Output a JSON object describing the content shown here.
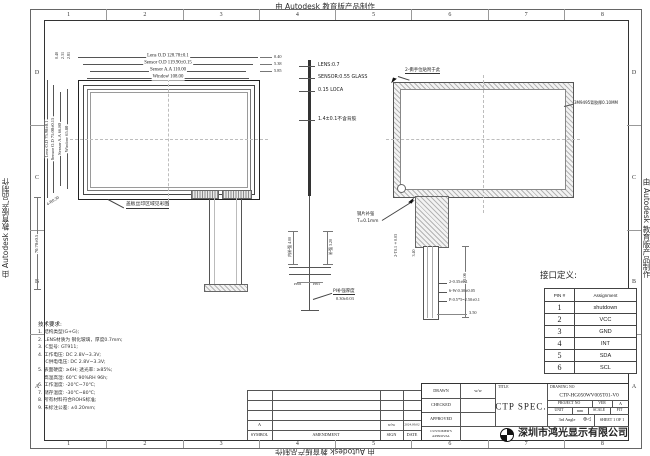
{
  "watermark": "由 Autodesk 教育版产品制作",
  "zones": {
    "cols": [
      "1",
      "2",
      "3",
      "4",
      "5",
      "6",
      "7",
      "8"
    ],
    "rows": [
      "D",
      "C",
      "B",
      "A"
    ]
  },
  "front": {
    "h_dims": [
      "Lens O.D 128.78±0.1",
      "Sensor O.D 119.90±0.15",
      "Sensor A.A 110.00",
      "Window 108.00"
    ],
    "v_dims": [
      "Lens O.D 75.98±0.1",
      "Sensor O.D 75.00±0.15",
      "Sensor A.A 66.80",
      "Window 65.80"
    ],
    "top_offsets": [
      "0.40",
      "2.31",
      "2.81"
    ],
    "right_offsets": [
      "0.40",
      "5.38",
      "5.85"
    ],
    "corner_note": "4-R0.30",
    "silk_note": "盖板丝印区域见彩图",
    "tail_dim": "70.70±0.5"
  },
  "stack": {
    "layers": [
      "LENS:0.7",
      "SENSOR:0.55 GLASS",
      "0.15 LOCA",
      "1.4±0.1不含背胶"
    ],
    "dim_left": "内补强 4.00",
    "dim_right": "补强 3.20",
    "pin_left": "PIN6",
    "pin_right": "PIN1",
    "callout_line1": "PI补强厚度",
    "callout_line2": "0.30±0.03"
  },
  "back": {
    "tear_note": "2-撕手位贴附于此",
    "tape_note": "3M9495背胶厚0.10MM",
    "stiffener_note1": "钢片补强",
    "stiffener_note2": "T=0.1mm",
    "side_note": "2-T0.1±0.03",
    "dim_a": "3.40",
    "dim_b": "22.06",
    "dim_c": "3.50",
    "specs": [
      "2-0.35±0.1",
      "6-W:0.30±0.05",
      "P:0.5*5=2.50±0.1"
    ]
  },
  "pin_table": {
    "title": "接口定义:",
    "headers": [
      "PIN #",
      "Assignment"
    ],
    "rows": [
      [
        "1",
        "shutdown"
      ],
      [
        "2",
        "VCC"
      ],
      [
        "3",
        "GND"
      ],
      [
        "4",
        "INT"
      ],
      [
        "5",
        "SDA"
      ],
      [
        "6",
        "SCL"
      ]
    ]
  },
  "notes": {
    "title": "技术要求:",
    "items": [
      "1. 结构类型(G+G);",
      "2. LENS材质为 钢化玻璃，厚度0.7mm;",
      "3. IC型号: GT911;",
      "4. 工作电压: DC 2.8V~3.3V;",
      "    IC供电电压: DC 2.8V~3.3V;",
      "5. 表面硬度: ≥6H; 透光率: ≥85%;",
      "    高温高湿: 60℃ 90%RH 96h;",
      "6. 工作温度: -20℃~70℃;",
      "7. 储存温度: -30℃~80℃;",
      "8. 所有材料符合ROHS标准;",
      "9. 未标注公差: ±0.20mm;"
    ]
  },
  "revision": {
    "headers": [
      "SYMBOL",
      "AMENDMENT",
      "SIGN",
      "DATE"
    ],
    "symbol": "A",
    "sign": "w/w",
    "date": "2024.09.02"
  },
  "title_block": {
    "drawn": "DRAWN",
    "drawn_sign": "w/w",
    "checked": "CHECKED",
    "approved": "APPROVED",
    "customer": "CUSTOMER'S APPROVAL",
    "title_label": "TITLE",
    "title": "CTP  SPEC.",
    "drawing_no_label": "DRAWING NO",
    "drawing_no": "CTP-HG050WV005T01-V0",
    "project_label": "PROJECT NO",
    "ver_label": "VER",
    "ver": "A",
    "unit_label": "UNIT",
    "unit": "mm",
    "scale_label": "SCALE",
    "fit_label": "FIT",
    "angle": "3rd Angle",
    "angle_symbol": "⊕◁",
    "sheet": "SHEET 1 OF 1",
    "company": "深圳市鸿光显示有限公司"
  }
}
